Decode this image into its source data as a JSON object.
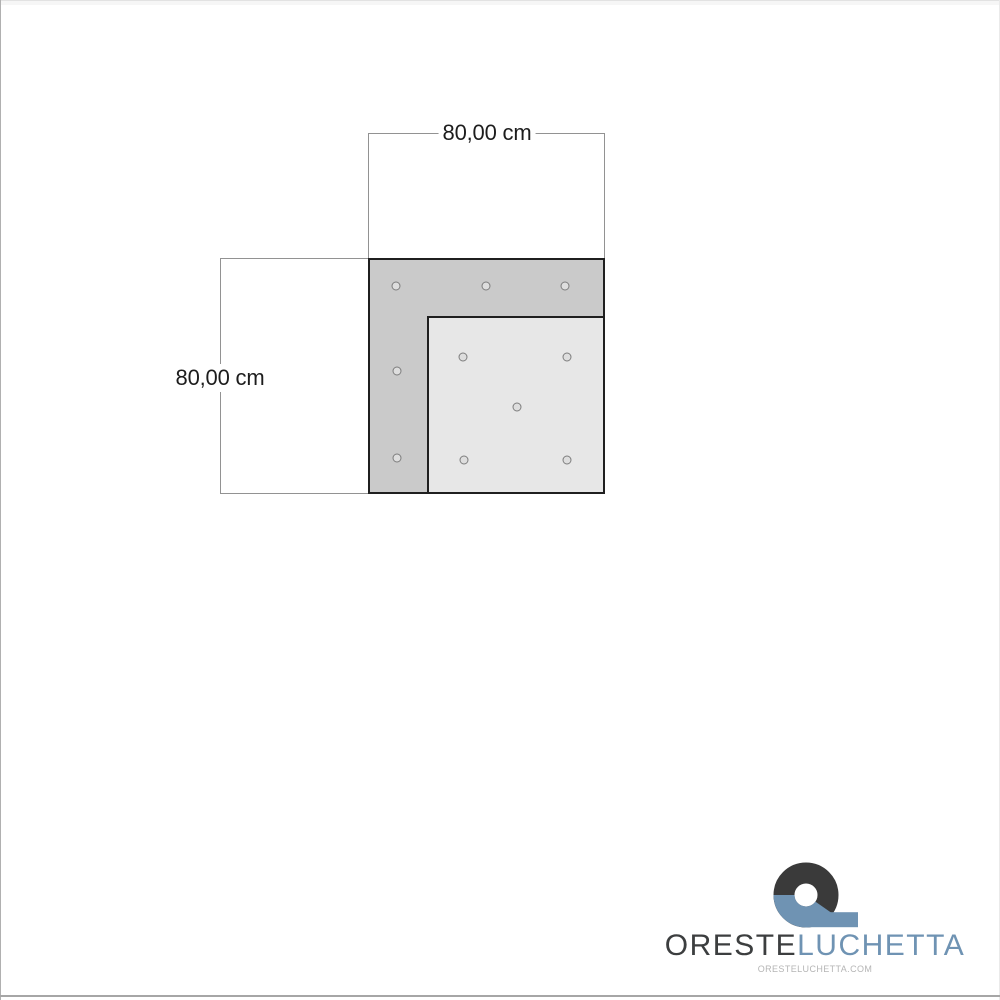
{
  "page": {
    "background_color": "#ffffff",
    "frame_color": "#a6a6a6"
  },
  "diagram": {
    "type": "technical-drawing",
    "subject": "corner panel top view with mounting holes",
    "width_label": "80,00 cm",
    "height_label": "80,00 cm",
    "panel_dark_color": "#cacaca",
    "panel_light_color": "#e7e7e7",
    "outline_color": "#1f1f1f",
    "dim_line_color": "#929292",
    "hole_count": 10
  },
  "branding": {
    "name_primary": "ORESTE",
    "name_secondary": "LUCHETTA",
    "website": "ORESTELUCHETTA.COM",
    "primary_color": "#3c3e3f",
    "accent_color": "#6f93b3",
    "website_color": "#b5b5b5",
    "logo_mark": "q-ribbon-icon"
  }
}
